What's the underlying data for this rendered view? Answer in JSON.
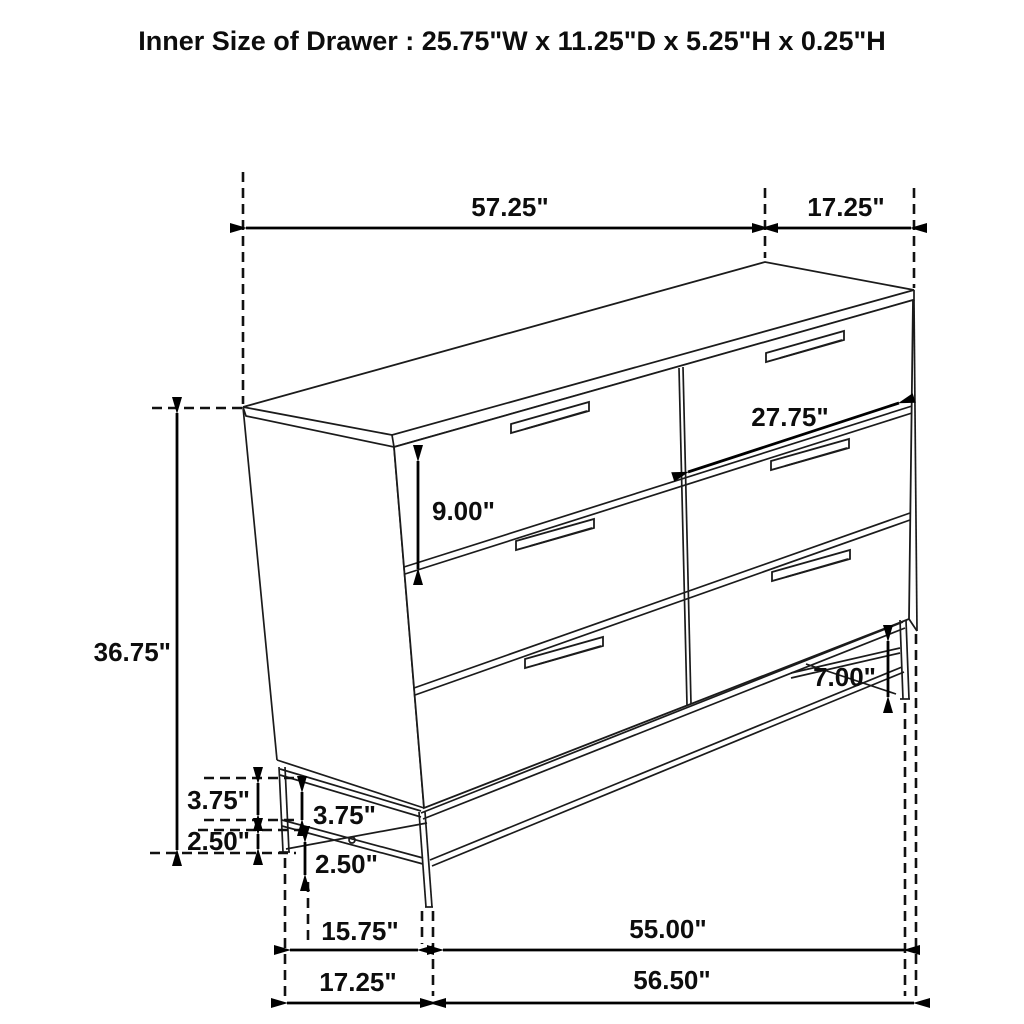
{
  "title": "Inner Size of Drawer : 25.75\"W x 11.25\"D x 5.25\"H x 0.25\"H",
  "diagram": {
    "type": "furniture-dimension-drawing",
    "subject": "6-drawer dresser on metal leg frame",
    "dimensions": {
      "top_width": "57.25\"",
      "top_depth": "17.25\"",
      "drawer_face_width": "27.75\"",
      "drawer_face_height": "9.00\"",
      "overall_height": "36.75\"",
      "leg_clearance_right": "7.00\"",
      "frame_rail_left": "3.75\"",
      "frame_rail_front": "3.75\"",
      "foot_left": "2.50\"",
      "foot_front": "2.50\"",
      "base_span_side": "15.75\"",
      "base_span_front": "55.00\"",
      "base_depth_total": "17.25\"",
      "base_width_total": "56.50\""
    }
  }
}
